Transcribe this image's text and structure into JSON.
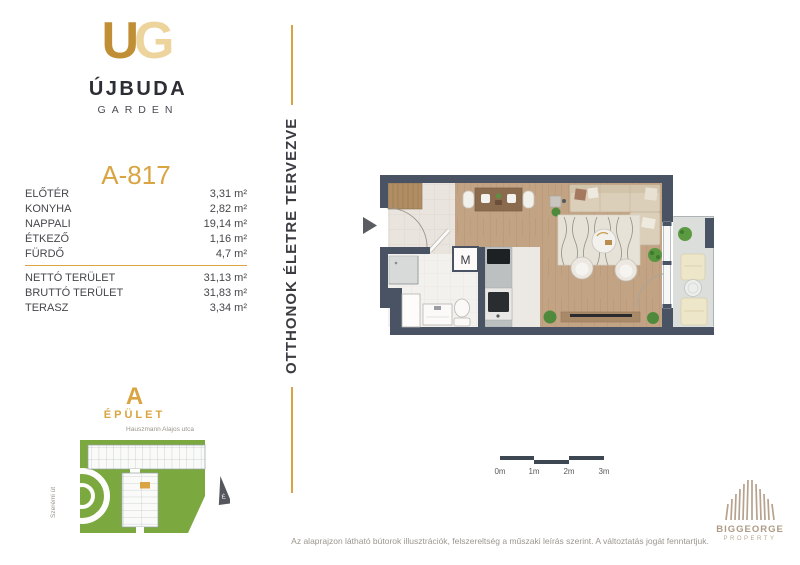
{
  "logo": {
    "monogram_u": "U",
    "monogram_g": "G",
    "name": "ÚJBUDA",
    "subname": "GARDEN"
  },
  "tagline": "OTTHONOK ÉLETRE TERVEZVE",
  "unit": {
    "id": "A-817",
    "rooms": [
      {
        "label": "ELŐTÉR",
        "value": "3,31 m²"
      },
      {
        "label": "KONYHA",
        "value": "2,82 m²"
      },
      {
        "label": "NAPPALI",
        "value": "19,14 m²"
      },
      {
        "label": "ÉTKEZŐ",
        "value": "1,16 m²"
      },
      {
        "label": "FÜRDŐ",
        "value": "4,7 m²"
      }
    ],
    "totals": [
      {
        "label": "NETTÓ TERÜLET",
        "value": "31,13 m²"
      },
      {
        "label": "BRUTTÓ TERÜLET",
        "value": "31,83 m²"
      },
      {
        "label": "TERASZ",
        "value": "3,34 m²"
      }
    ]
  },
  "floorplan": {
    "washing_machine_label": "M"
  },
  "scalebar": {
    "labels": [
      "0m",
      "1m",
      "2m",
      "3m"
    ]
  },
  "sitemap": {
    "building_letter": "A",
    "building_word": "ÉPÜLET",
    "street_top": "Hauszmann Alajos utca",
    "street_left": "Szerémi út",
    "north_label": "É"
  },
  "footer": {
    "disclaimer": "Az alaprajzon látható bútorok illusztrációk, felszereltség a műszaki leírás szerint. A változtatás jogát fenntartjuk."
  },
  "brand": {
    "name": "BIGGEORGE",
    "subname": "PROPERTY"
  },
  "colors": {
    "accent_gold": "#D9A441",
    "wall_dark": "#4A5364",
    "wood_floor": "#C2A384",
    "site_green": "#7BA83F",
    "brand_tan": "#B7A28D"
  }
}
